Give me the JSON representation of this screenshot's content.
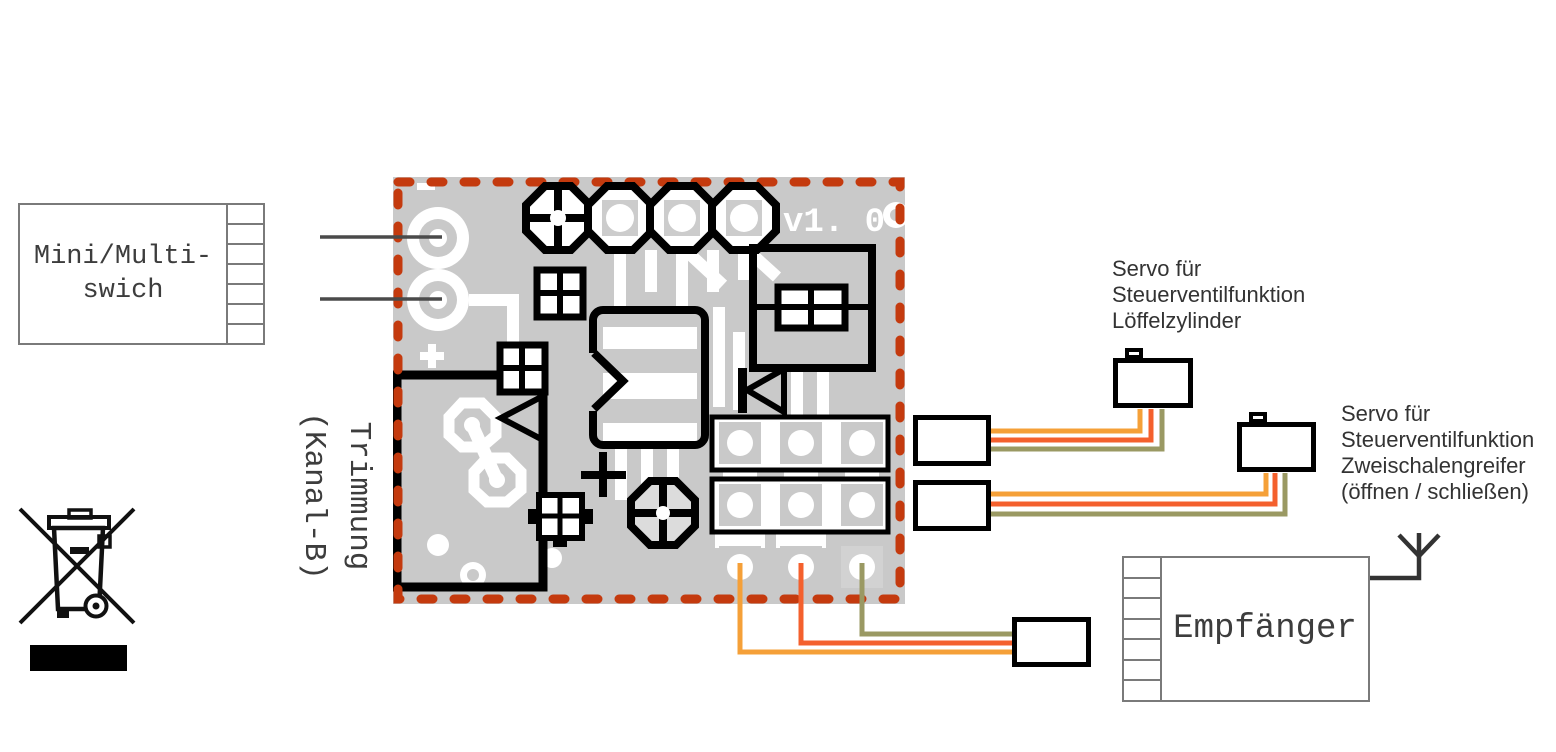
{
  "diagram": {
    "mini_switch": {
      "label_lines": [
        "Mini/Multi-",
        "swich"
      ],
      "cell_count": 7
    },
    "board": {
      "version": "v1. 0",
      "trim_label_lines": [
        "Trimmung",
        "(Kanal-B)"
      ]
    },
    "servo1": {
      "label_lines": [
        "Servo für",
        "Steuerventilfunktion",
        "Löffelzylinder"
      ]
    },
    "servo2": {
      "label_lines": [
        "Servo für",
        "Steuerventilfunktion",
        "Zweischalengreifer",
        "(öffnen / schließen)"
      ]
    },
    "receiver": {
      "label": "Empfänger",
      "cell_count": 7
    },
    "colors": {
      "board_gray": "#c9c9c9",
      "border_red": "#c43a0e",
      "wire_orange": "#f5a038",
      "wire_red": "#f4602d",
      "wire_olive": "#9a9963",
      "line_gray": "#4a4a4a",
      "box_gray": "#7a7a7a",
      "text_dark": "#3d3d3d"
    }
  }
}
